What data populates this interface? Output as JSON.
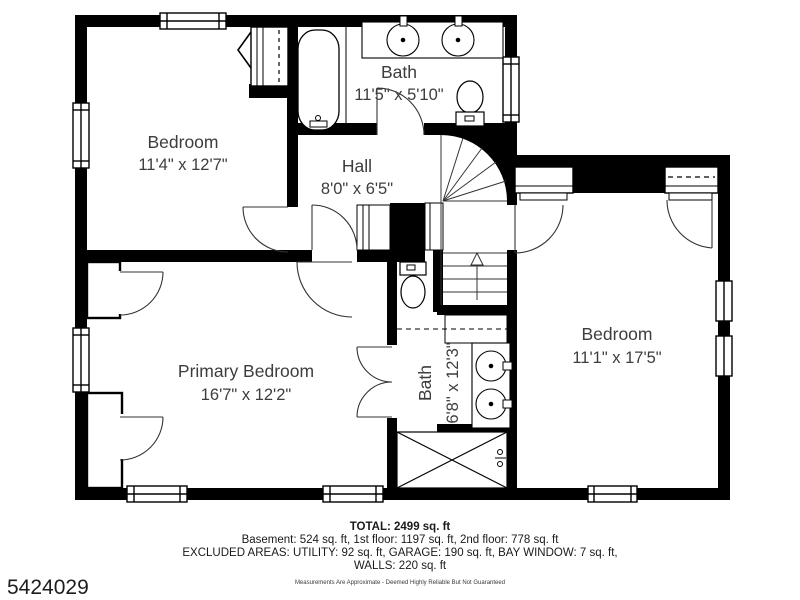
{
  "plan": {
    "rooms": [
      {
        "id": "bedroom-top-left",
        "name": "Bedroom",
        "dims": "11'4\" x 12'7\""
      },
      {
        "id": "bath-top",
        "name": "Bath",
        "dims": "11'5\" x 5'10\""
      },
      {
        "id": "hall",
        "name": "Hall",
        "dims": "8'0\" x 6'5\""
      },
      {
        "id": "primary-bedroom",
        "name": "Primary Bedroom",
        "dims": "16'7\" x 12'2\""
      },
      {
        "id": "bath-lower",
        "name": "Bath",
        "dims": "6'8\" x 12'3\""
      },
      {
        "id": "bedroom-right",
        "name": "Bedroom",
        "dims": "11'1\" x 17'5\""
      }
    ]
  },
  "summary": {
    "total": "TOTAL: 2499 sq. ft",
    "floors": "Basement: 524 sq. ft, 1st floor: 1197 sq. ft, 2nd floor: 778 sq. ft",
    "excluded": "EXCLUDED AREAS: UTILITY: 92 sq. ft, GARAGE: 190 sq. ft, BAY WINDOW: 7 sq. ft,",
    "walls": "WALLS: 220 sq. ft",
    "disclaimer": "Measurements Are Approximate - Deemed Highly Reliable But Not Guaranteed"
  },
  "listing_id": "5424029",
  "colors": {
    "wall": "#000000",
    "background": "#ffffff",
    "room_text": "#3d3d3d",
    "footer_text": "#1a1a1a"
  }
}
